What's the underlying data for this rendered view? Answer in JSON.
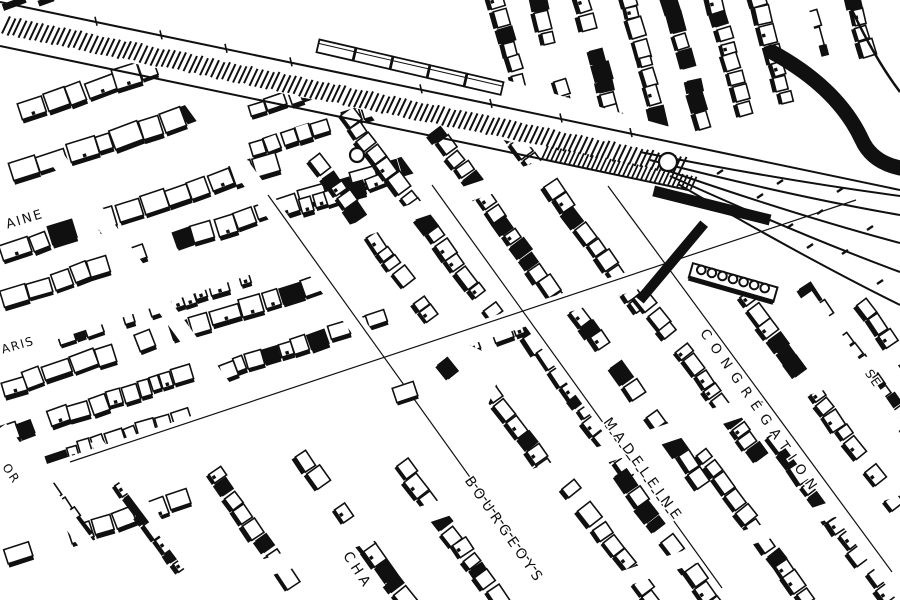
{
  "map": {
    "type": "hand-drawn-isometric-city-map",
    "ink_color": "#101010",
    "paper_color": "#ffffff",
    "features": {
      "railway": "hatched railway corridor with freight cars and track fan at right",
      "blocks": "dense rowhouse blocks drawn in black-ink axonometric style"
    },
    "street_labels": [
      {
        "id": "aine",
        "text": "AINE",
        "x": 26,
        "y": 223,
        "rot": -17,
        "fs": 13,
        "ls": 2
      },
      {
        "id": "aris",
        "text": "ARIS",
        "x": 19,
        "y": 349,
        "rot": -16,
        "fs": 12,
        "ls": 1.5
      },
      {
        "id": "or-fragment",
        "text": "OR",
        "x": 8,
        "y": 476,
        "rot": 56,
        "fs": 12,
        "ls": 2
      },
      {
        "id": "cha-fragment",
        "text": "CHA",
        "x": 354,
        "y": 573,
        "rot": 57,
        "fs": 14,
        "ls": 4
      },
      {
        "id": "bourgeoys",
        "text": "BOURGEOYS",
        "x": 501,
        "y": 533,
        "rot": 55,
        "fs": 14,
        "ls": 4.5
      },
      {
        "id": "madeleine",
        "text": "MADELEINE",
        "x": 640,
        "y": 473,
        "rot": 54,
        "fs": 14,
        "ls": 5
      },
      {
        "id": "congregation",
        "text": "CONGRÉGATION",
        "x": 757,
        "y": 415,
        "rot": 55,
        "fs": 13.5,
        "ls": 7.5
      },
      {
        "id": "se-fragment",
        "text": "SE",
        "x": 870,
        "y": 381,
        "rot": 55,
        "fs": 12,
        "ls": 2
      }
    ]
  }
}
